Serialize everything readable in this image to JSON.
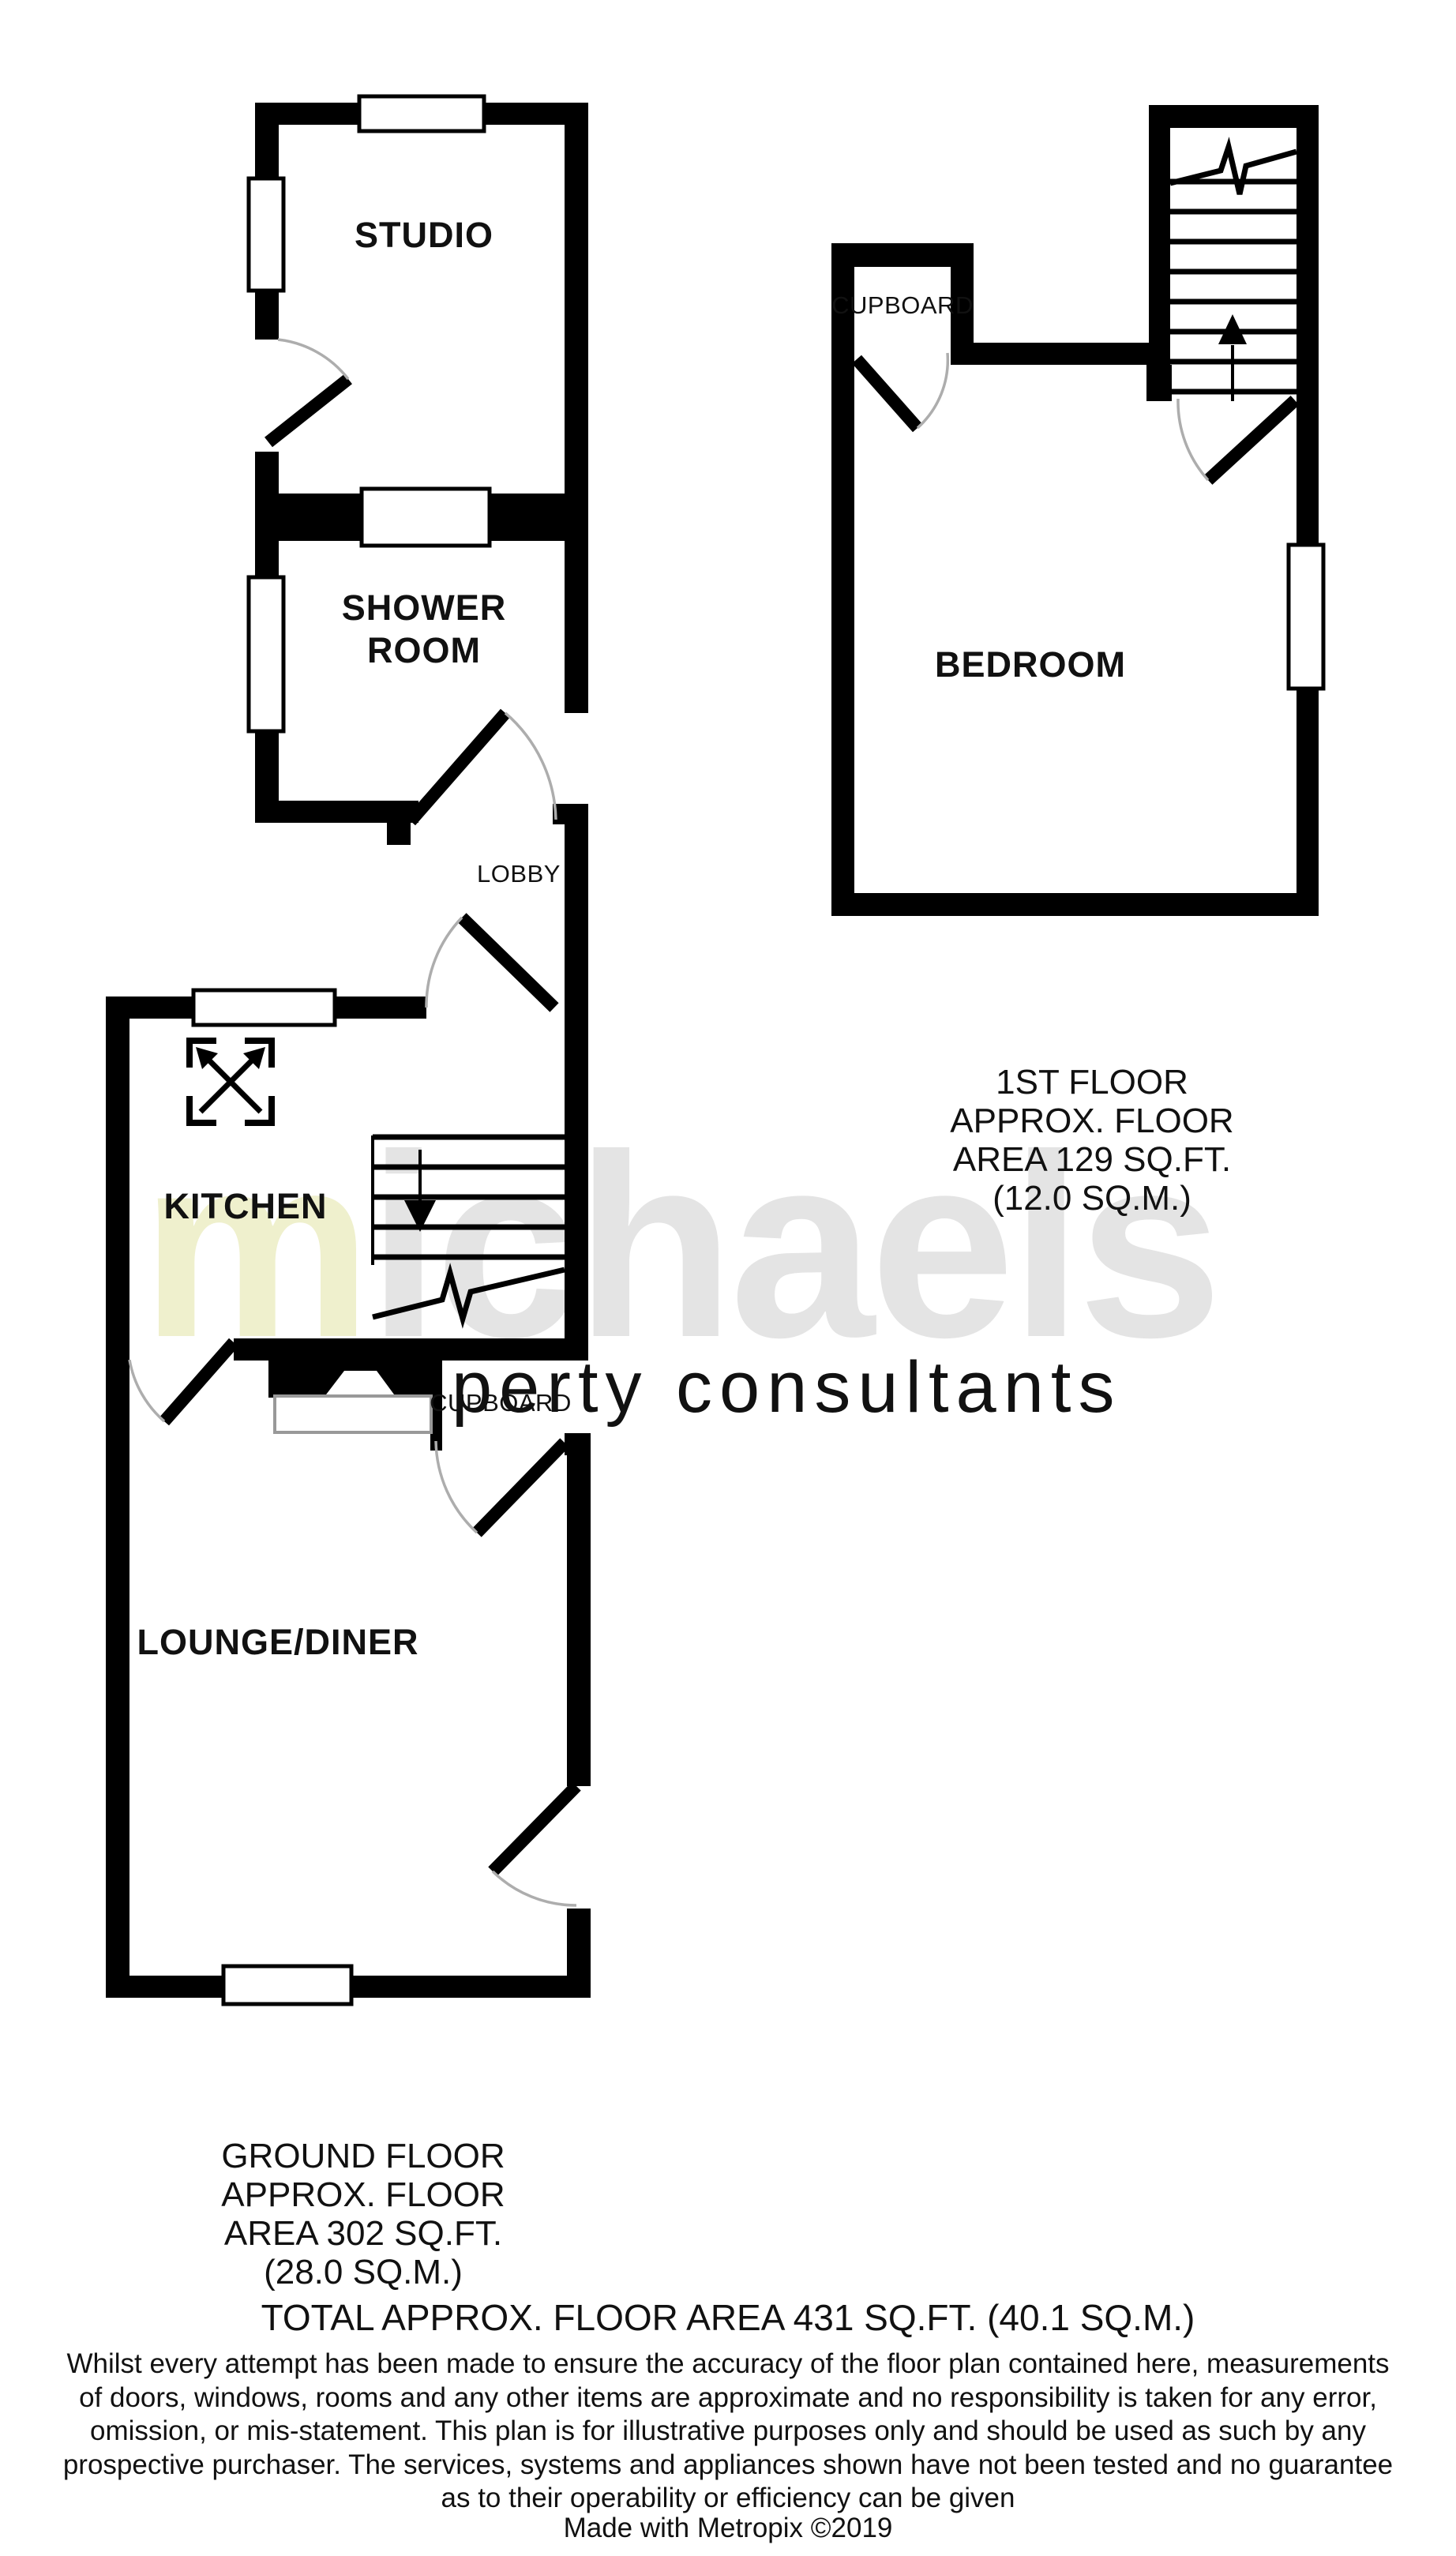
{
  "plan": {
    "rooms": {
      "studio": "STUDIO",
      "shower_line1": "SHOWER",
      "shower_line2": "ROOM",
      "lobby": "LOBBY",
      "kitchen": "KITCHEN",
      "cupboard_ground": "CUPBOARD",
      "lounge_diner": "LOUNGE/DINER",
      "bedroom": "BEDROOM",
      "cupboard_first": "CUPBOARD"
    },
    "captions": {
      "first_floor": [
        "1ST FLOOR",
        "APPROX. FLOOR",
        "AREA 129 SQ.FT.",
        "(12.0 SQ.M.)"
      ],
      "ground_floor": [
        "GROUND FLOOR",
        "APPROX. FLOOR",
        "AREA 302 SQ.FT.",
        "(28.0 SQ.M.)"
      ],
      "total": "TOTAL APPROX. FLOOR AREA 431 SQ.FT. (40.1 SQ.M.)"
    },
    "disclaimer": {
      "lines": [
        "Whilst every attempt has been made to ensure the accuracy of the floor plan contained here, measurements",
        "of doors, windows, rooms and any other items are approximate and no responsibility is taken for any error,",
        "omission, or mis-statement. This plan is for illustrative purposes only and should be used as such by any",
        "prospective purchaser. The services, systems and appliances shown have not been tested and no guarantee",
        "as to their operability or efficiency can be given"
      ],
      "credit": "Made with Metropix ©2019"
    },
    "watermark": {
      "initial": "m",
      "rest": "ichaels",
      "tagline": "property consultants",
      "initial_color": "#eff0cd",
      "rest_color": "#e4e4e4",
      "tagline_color": "#ededbc"
    },
    "colors": {
      "wall": "#000000",
      "door_arc": "#adadad",
      "hearth_outline": "#999999",
      "background": "#ffffff"
    }
  }
}
